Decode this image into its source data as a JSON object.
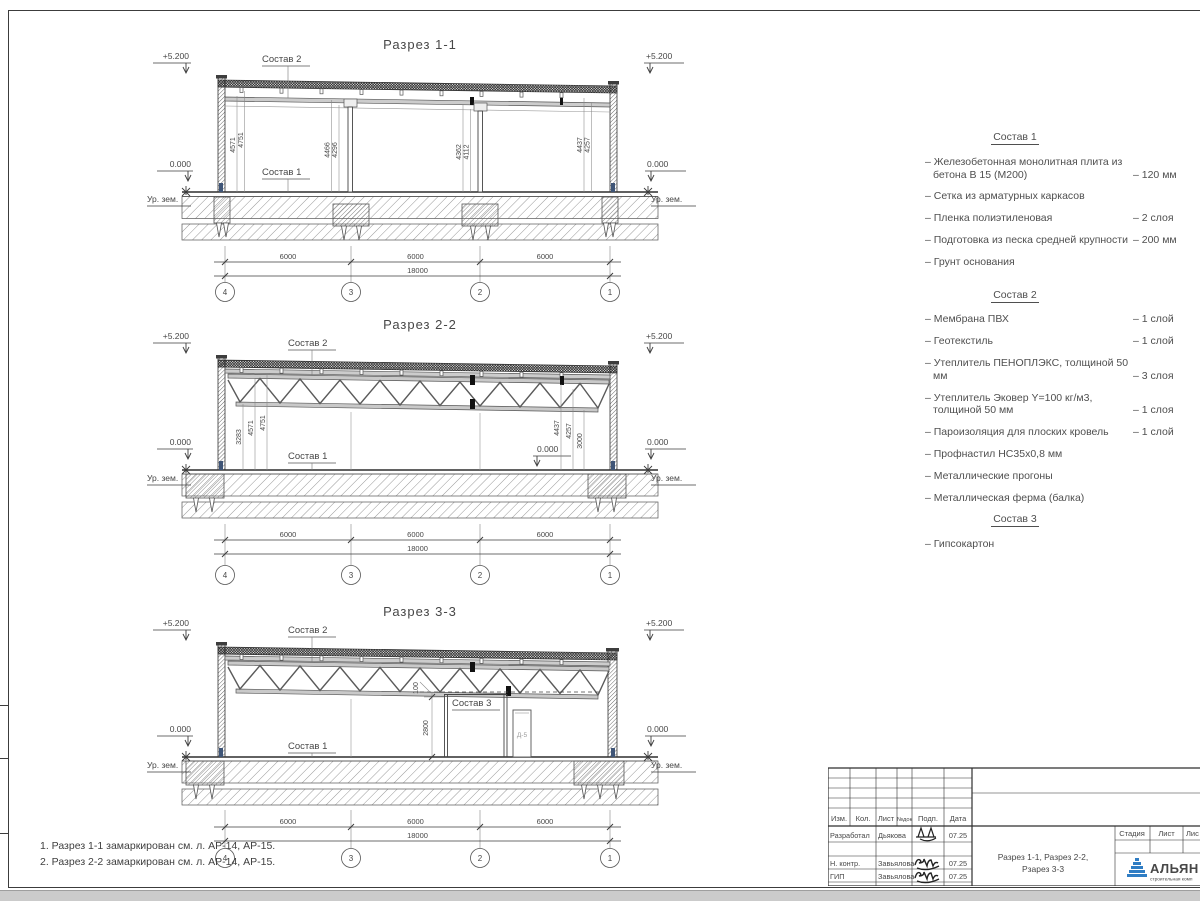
{
  "frame": {
    "notes": [
      "1. Разрез 1-1 замаркирован см. л. АР-14, АР-15.",
      "2. Разрез 2-2 замаркирован см. л. АР-14, АР-15."
    ]
  },
  "sections": [
    {
      "title": "Разрез 1-1",
      "elev": "+5.200",
      "zero": "0.000",
      "ground": "Ур. зем.",
      "s2": "Состав 2",
      "s1": "Состав 1",
      "vdims": [
        "4571",
        "4751",
        "4466",
        "4296",
        "4362",
        "4112",
        "4437",
        "4257"
      ],
      "spans": [
        "6000",
        "6000",
        "6000"
      ],
      "total": "18000",
      "grids": [
        "4",
        "3",
        "2",
        "1"
      ]
    },
    {
      "title": "Разрез 2-2",
      "elev": "+5.200",
      "zero": "0.000",
      "zero_mid": "0.000",
      "ground": "Ур. зем.",
      "s2": "Состав 2",
      "s1": "Состав 1",
      "vdims": [
        "3283",
        "4571",
        "4751",
        "4437",
        "4257",
        "3000"
      ],
      "spans": [
        "6000",
        "6000",
        "6000"
      ],
      "total": "18000",
      "grids": [
        "4",
        "3",
        "2",
        "1"
      ]
    },
    {
      "title": "Разрез 3-3",
      "elev": "+5.200",
      "zero": "0.000",
      "ground": "Ур. зем.",
      "s2": "Состав 2",
      "s1": "Состав 1",
      "s3": "Состав 3",
      "door": "Д-5",
      "pdims": [
        "100",
        "2800"
      ],
      "spans": [
        "6000",
        "6000",
        "6000"
      ],
      "total": "18000",
      "grids": [
        "4",
        "3",
        "2",
        "1"
      ]
    }
  ],
  "specs": [
    {
      "title": "Состав 1",
      "items": [
        {
          "text": "– Железобетонная  монолитная плита из бетона В 15 (М200)",
          "value": "– 120 мм"
        },
        {
          "text": "– Сетка из арматурных каркасов",
          "value": ""
        },
        {
          "text": "– Пленка полиэтиленовая",
          "value": "– 2 слоя"
        },
        {
          "text": "– Подготовка из песка средней крупности",
          "value": "– 200 мм"
        },
        {
          "text": "– Грунт основания",
          "value": ""
        }
      ]
    },
    {
      "title": "Состав 2",
      "items": [
        {
          "text": "– Мембрана ПВХ",
          "value": "– 1 слой"
        },
        {
          "text": "– Геотекстиль",
          "value": "– 1 слой"
        },
        {
          "text": "– Утеплитель ПЕНОПЛЭКС, толщиной 50 мм",
          "value": "– 3 слоя"
        },
        {
          "text": "– Утеплитель Эковер Y=100 кг/м3, толщиной 50 мм",
          "value": "– 1 слоя"
        },
        {
          "text": "– Пароизоляция для плоских кровель",
          "value": "– 1 слой"
        },
        {
          "text": "– Профнастил НС35х0,8 мм",
          "value": ""
        },
        {
          "text": "– Металлические прогоны",
          "value": ""
        },
        {
          "text": "– Металлическая ферма (балка)",
          "value": ""
        }
      ]
    },
    {
      "title": "Состав 3",
      "items": [
        {
          "text": "– Гипсокартон",
          "value": ""
        }
      ]
    }
  ],
  "title_block": {
    "cols": [
      "Изм.",
      "Кол.",
      "Лист",
      "№док",
      "Подп.",
      "Дата"
    ],
    "rows": [
      {
        "role": "Разработал",
        "name": "Дьякова",
        "date": "07.25"
      },
      {
        "role": "Н. контр.",
        "name": "Завьялова",
        "date": "07.25"
      },
      {
        "role": "ГИП",
        "name": "Завьялова",
        "date": "07.25"
      }
    ],
    "doc_title_1": "Разрез 1-1, Разрез 2-2,",
    "doc_title_2": "Рзарез 3-3",
    "stage_cols": [
      "Стадия",
      "Лист",
      "Лис"
    ],
    "logo": {
      "name": "АЛЬЯН",
      "subtitle": "строительная комп"
    },
    "colors": {
      "logo_text": "#16357f",
      "logo_triangle": "#2f7dc4",
      "logo_subtitle": "#2f7dc4"
    }
  }
}
